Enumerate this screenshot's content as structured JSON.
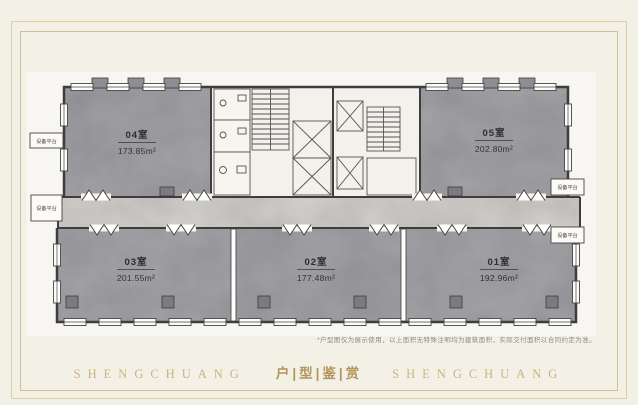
{
  "page": {
    "background": "#f3f0e5",
    "frame_outer_color": "#dccfaa",
    "frame_inner_color": "#cfc096"
  },
  "floorplan": {
    "rooms": [
      {
        "id": "04",
        "name": "04室",
        "area": "173.85m²"
      },
      {
        "id": "05",
        "name": "05室",
        "area": "202.80m²"
      },
      {
        "id": "03",
        "name": "03室",
        "area": "201.55m²"
      },
      {
        "id": "02",
        "name": "02室",
        "area": "177.48m²"
      },
      {
        "id": "01",
        "name": "01室",
        "area": "192.96m²"
      }
    ],
    "platform_label": "设备平台",
    "colors": {
      "room_fill": "#97979c",
      "corridor_fill": "#bab6b1",
      "wall": "#3e3d3b",
      "paper": "#f7f6f2"
    }
  },
  "disclaimer": "*户型图仅为展示使用，以上面积无特殊注明均为建筑面积，实际交付面积以合同约定为准。",
  "banner": {
    "left": "SHENGCHUANG",
    "center": "户|型|鉴|赏",
    "right": "SHENGCHUANG",
    "color": "#c9ab74"
  }
}
